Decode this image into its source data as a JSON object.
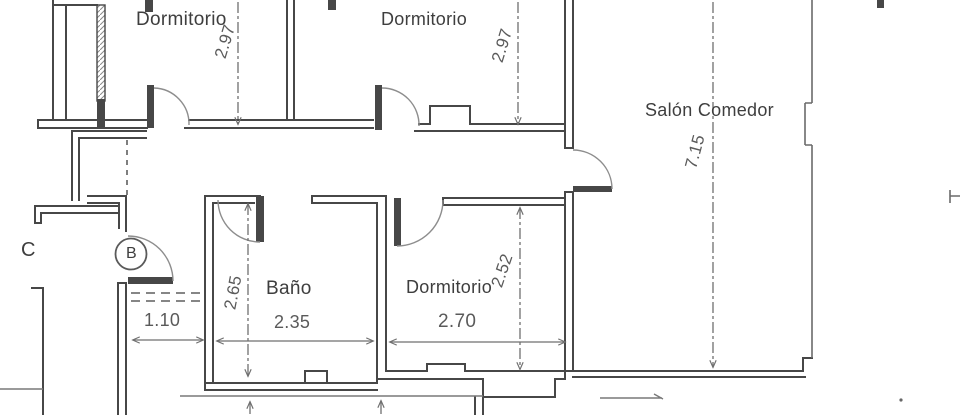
{
  "rooms": {
    "dormitorio_top_left": {
      "label": "Dormitorio",
      "depth_m": "2.97"
    },
    "dormitorio_top_middle": {
      "label": "Dormitorio",
      "depth_m": "2.97"
    },
    "salon_comedor": {
      "label": "Salón Comedor",
      "depth_m": "7.15"
    },
    "bano": {
      "label": "Baño",
      "width_m": "2.35",
      "depth_m": "2.65"
    },
    "dormitorio_bottom": {
      "label": "Dormitorio",
      "width_m": "2.70",
      "depth_m": "2.52"
    },
    "hallway": {
      "width_m": "1.10"
    }
  },
  "markers": {
    "door_label": "B",
    "wall_label": "C"
  },
  "colors": {
    "wall": "#474747",
    "dimension_line": "#6f6f6f",
    "label_text": "#3e3e3e",
    "background": "#ffffff"
  }
}
